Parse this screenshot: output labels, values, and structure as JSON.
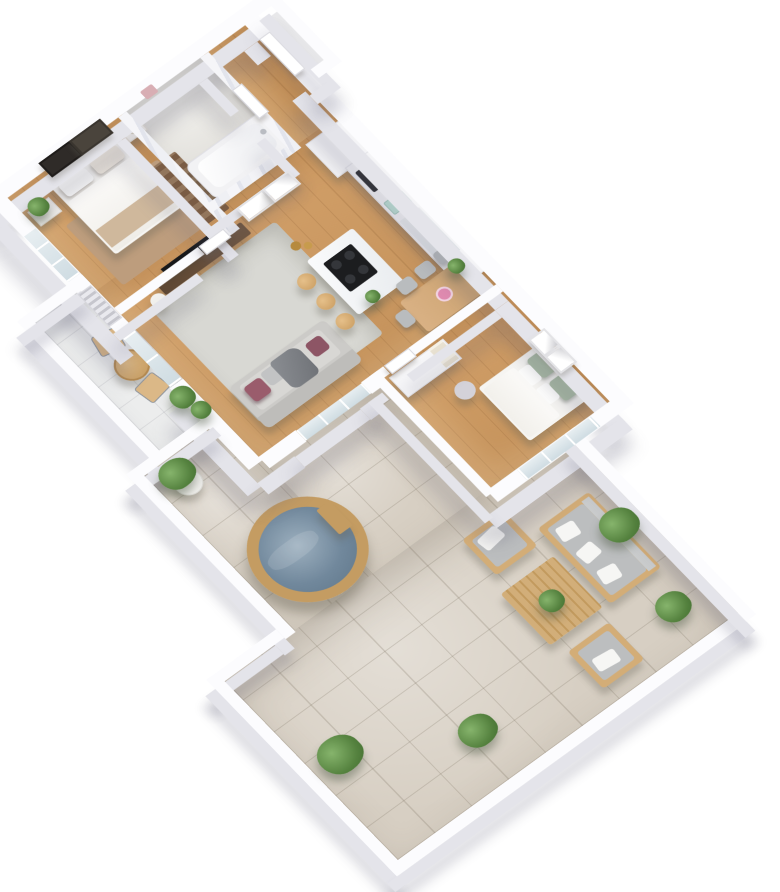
{
  "scene": {
    "type": "3d-floor-plan-render",
    "view": "isometric-top-down-apartment-with-terrace",
    "rooms": [
      {
        "name": "bedroom-1",
        "floor": "wood",
        "items": [
          "double-bed",
          "headboard",
          "pillows",
          "throw-blanket",
          "nightstand",
          "table-lamp",
          "plant-stand",
          "potted-plant",
          "beige-rug",
          "dark-runner-rug",
          "wall-art-dark",
          "wall-art-light",
          "window"
        ]
      },
      {
        "name": "bathroom",
        "floor": "stone",
        "items": [
          "bathtub",
          "marble-walls",
          "pink-towel",
          "door"
        ]
      },
      {
        "name": "entry-hall",
        "floor": "wood",
        "items": [
          "entry-door",
          "door-recess"
        ]
      },
      {
        "name": "kitchen",
        "floor": "wood",
        "items": [
          "wall-cabinets",
          "built-in-oven",
          "mint-appliance",
          "counter",
          "counter-plant",
          "marble-island",
          "induction-cooktop",
          "bar-stools",
          "gold-vases",
          "island-plant"
        ]
      },
      {
        "name": "living-dining-room",
        "floor": "wood",
        "items": [
          "gray-sofa",
          "plum-pillows",
          "gray-throw",
          "area-rug",
          "walnut-tv-console",
          "tv",
          "side-table",
          "dining-table",
          "dining-chairs",
          "pink-flowers",
          "wall-frames",
          "glass-door-to-terrace",
          "balcony-door"
        ]
      },
      {
        "name": "bedroom-2",
        "floor": "wood",
        "items": [
          "double-bed",
          "sage-pillows",
          "pouf",
          "wardrobe-with-open-shelf",
          "wall-art-frames",
          "window"
        ]
      },
      {
        "name": "balcony",
        "floor": "light-tile",
        "items": [
          "round-bistro-table",
          "wire-chairs",
          "potted-plants",
          "ac-louver"
        ]
      },
      {
        "name": "terrace",
        "floor": "stone-tile",
        "items": [
          "wooden-hot-tub",
          "tub-side-tray",
          "potted-plant",
          "outdoor-sofa",
          "outdoor-armchairs",
          "slatted-coffee-table",
          "table-plant",
          "bushes",
          "parapet-walls"
        ]
      }
    ]
  },
  "palette": {
    "wood": "#cf9a60",
    "tile": "#d7cfc3",
    "wtop": "#fcfcfe",
    "wside": "#e4e4ea",
    "glass_a": "#e7eef1",
    "glass_b": "#cfdce2",
    "walnut": "#5e4734",
    "tv": "#17181a",
    "sofa": "#cccbc8",
    "cushion": "#d8d7d4",
    "plum": "#9a5c6c",
    "throw": "#8b8e93",
    "rug_gray": "#d8d8d3",
    "rug_beige": "#bd9d7d",
    "runner": "#7a5c44",
    "sage": "#a9bba4",
    "mint": "#bfe3d8",
    "gold": "#b68a3e",
    "water": "#71889c",
    "water_light": "#9db0bf",
    "tub_wood": "#c49c62",
    "out_wood": "#d3ad77",
    "out_cushion": "#bcbebf",
    "plant": "#55823f",
    "plant_light": "#86b46c",
    "table_wood": "#d9b184",
    "chair_gray": "#b9bcbe",
    "pink": "#e08bb0",
    "stool": "#c79a5e",
    "headboard": "#d8c7ac",
    "linen": "#f6f5f2",
    "beige_throw": "#cfb89c",
    "frame_dark": "#2f2b28",
    "frame_mid": "#4a443c",
    "pot_white": "#f2f1ee"
  }
}
